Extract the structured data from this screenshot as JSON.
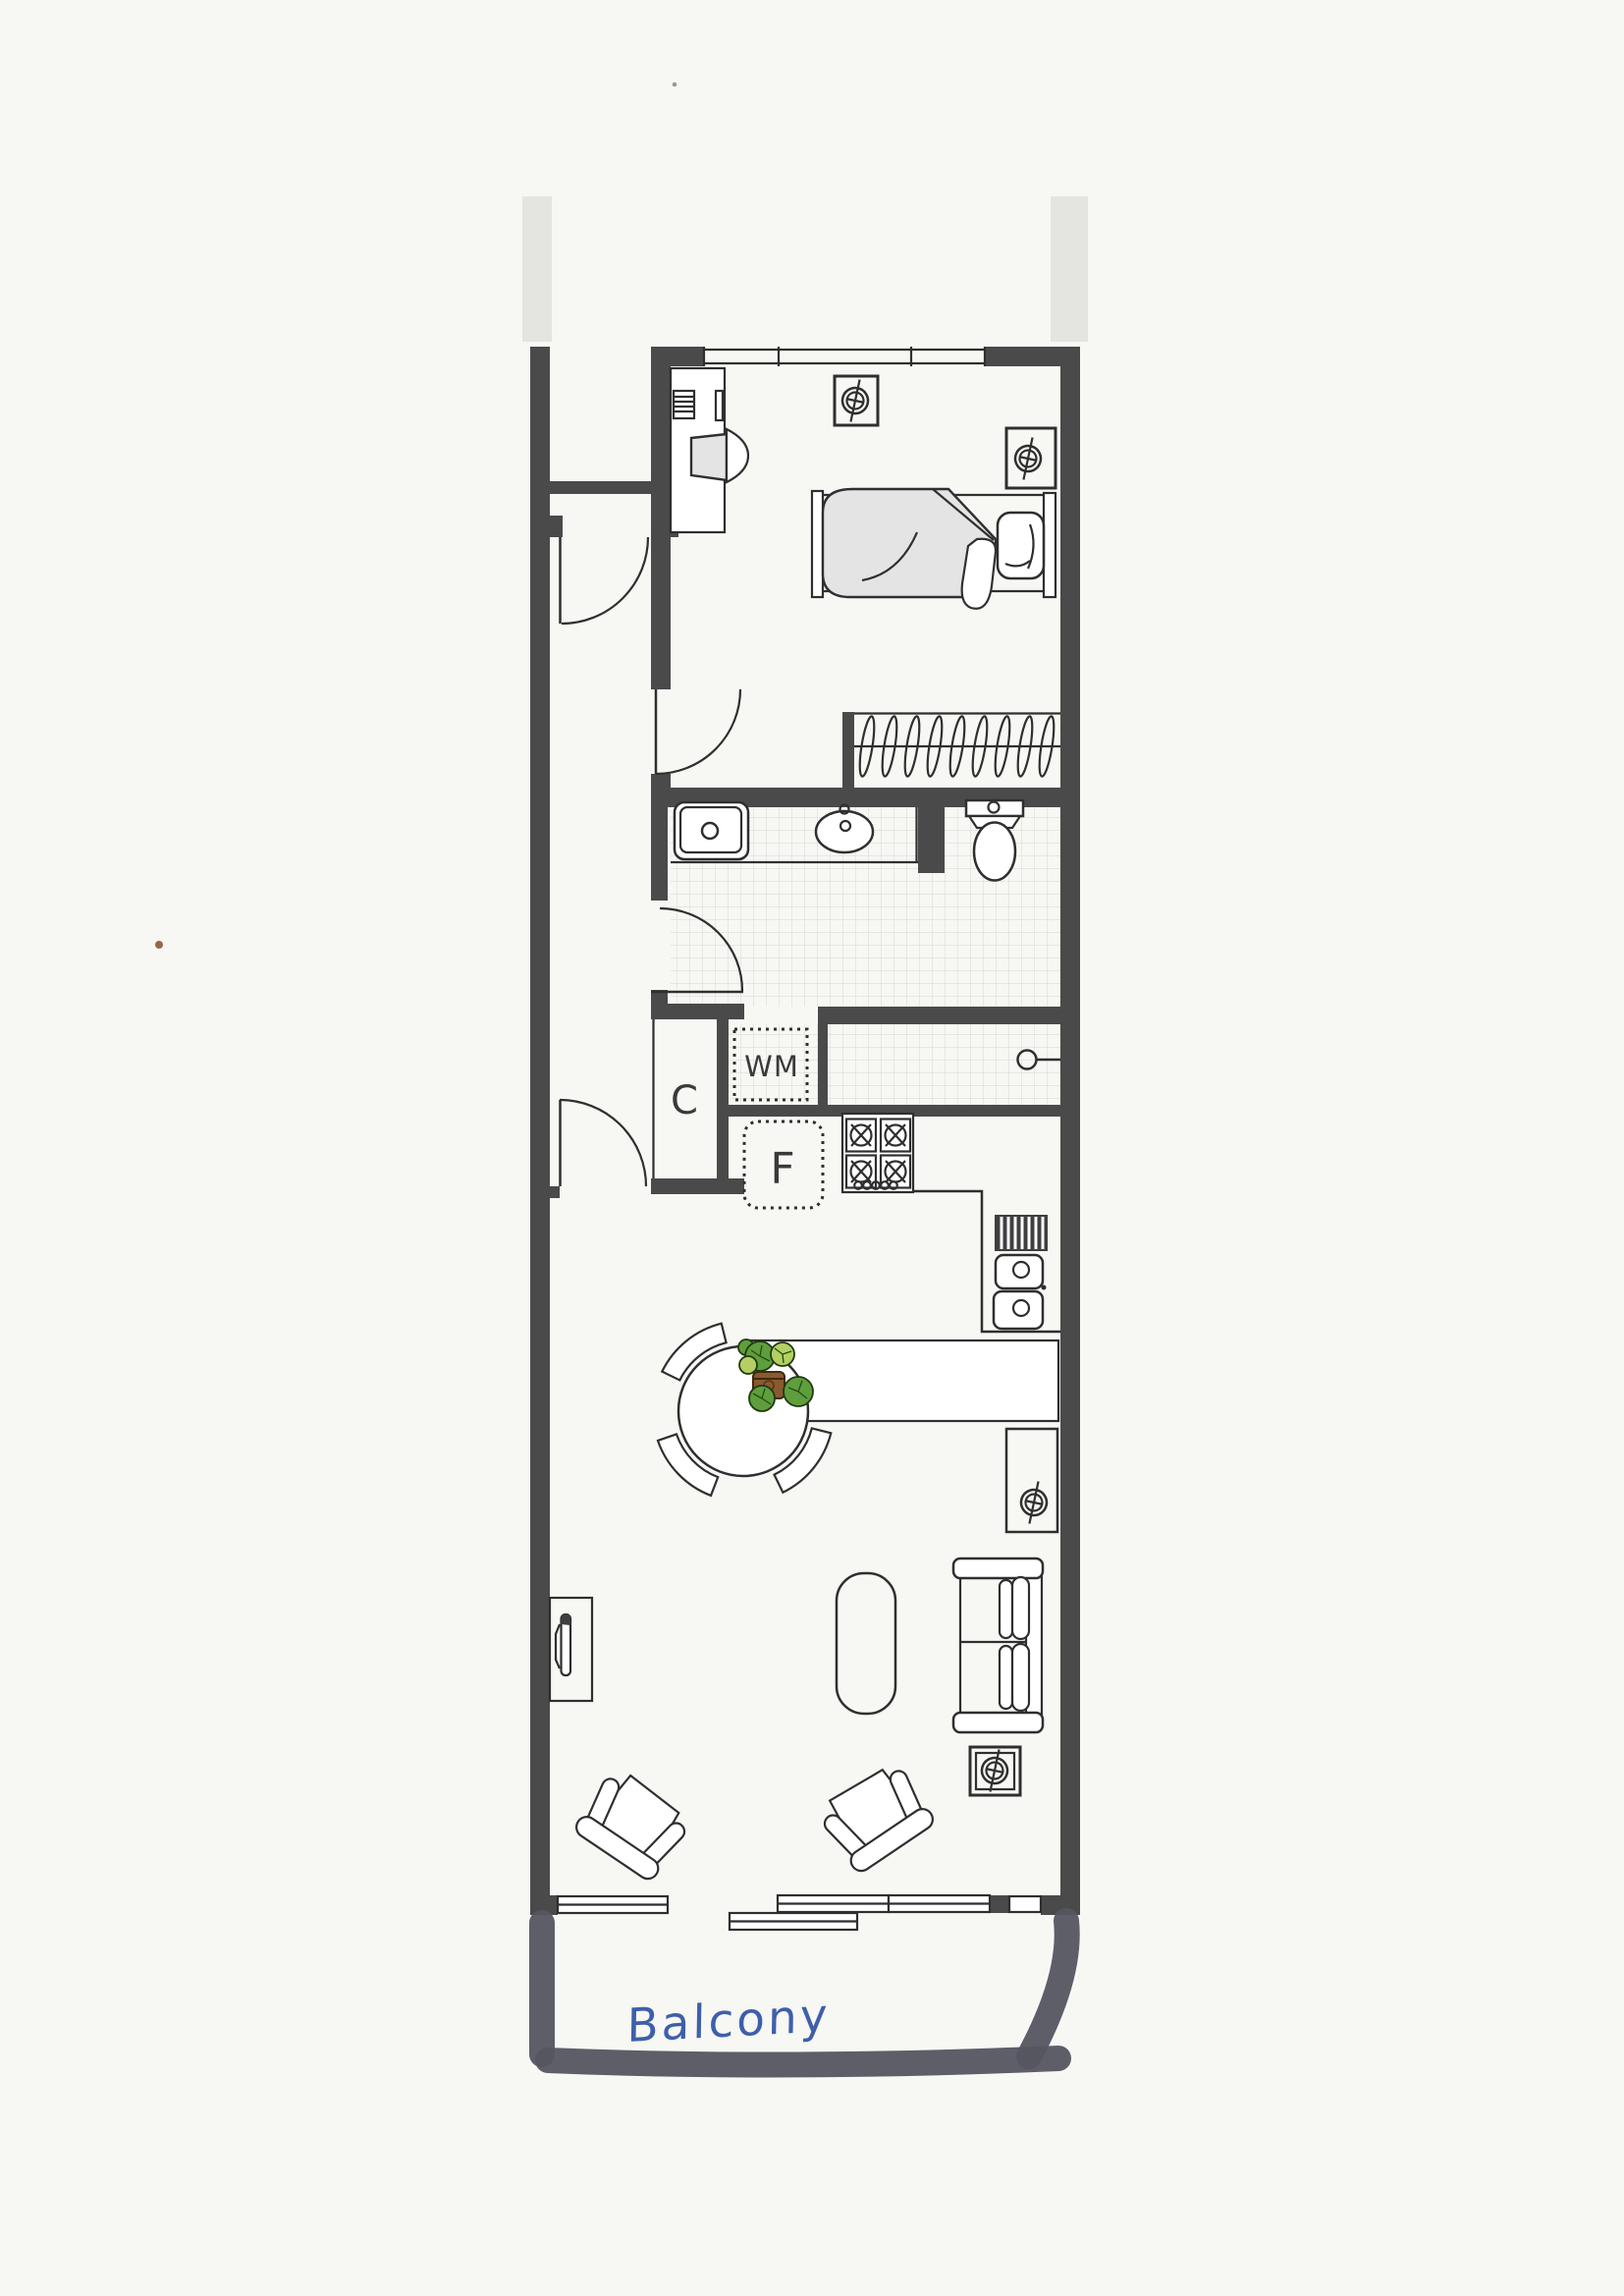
{
  "plan": {
    "title": "apartment-floor-plan-scan",
    "labels": {
      "closet": "C",
      "washing_machine": "WM",
      "fridge": "F",
      "balcony": "Balcony"
    },
    "rooms": [
      "bedroom",
      "bathroom",
      "hallway",
      "kitchen",
      "living-dining",
      "balcony"
    ],
    "icons": [
      "ceiling-light-icon",
      "stove-burner-icon",
      "toilet-icon",
      "sink-icon",
      "basin-icon",
      "bed-icon",
      "wardrobe-rail-icon",
      "sofa-icon",
      "armchair-icon",
      "dining-table-icon",
      "plant-icon",
      "tv-icon",
      "door-swing-icon",
      "sliding-door-icon"
    ],
    "colors": {
      "paper": "#f7f7f4",
      "wall": "#4a4a4a",
      "line": "#2f2f2f",
      "tile": "#dcdcd8",
      "fill_light": "#e4e4e4",
      "balcony_marker": "#555561",
      "label_ink": "#3a3a3a",
      "handwriting_blue": "#3e5faa",
      "plant_green": "#5f9e3c",
      "plant_light_green": "#b5cf63",
      "pot_brown": "#8a5a2e"
    }
  }
}
